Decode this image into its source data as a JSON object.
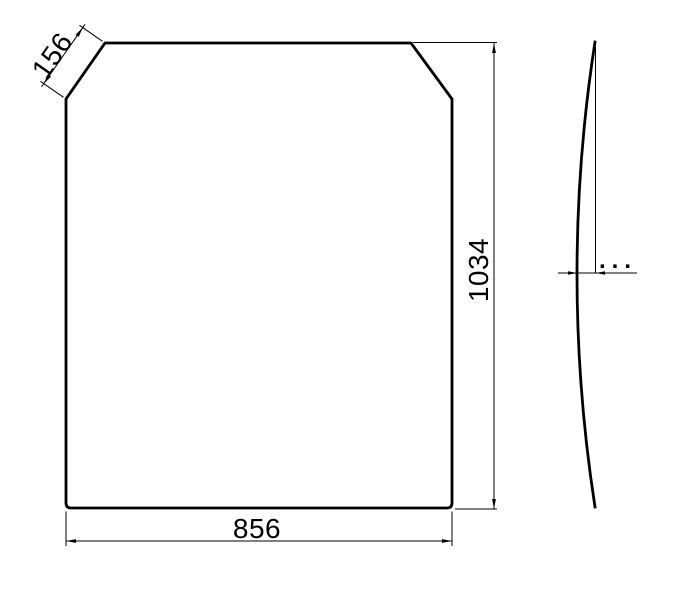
{
  "page": {
    "background": "#ffffff",
    "line_color": "#000000"
  },
  "front_view": {
    "description": "panel front view with chamfered top corners",
    "dim_chamfer": {
      "value": "156"
    },
    "dim_height": {
      "value": "1034"
    },
    "dim_width": {
      "value": "856"
    }
  },
  "side_view": {
    "description": "panel side profile showing bow curvature",
    "dim_bow": {
      "value": "..."
    }
  }
}
